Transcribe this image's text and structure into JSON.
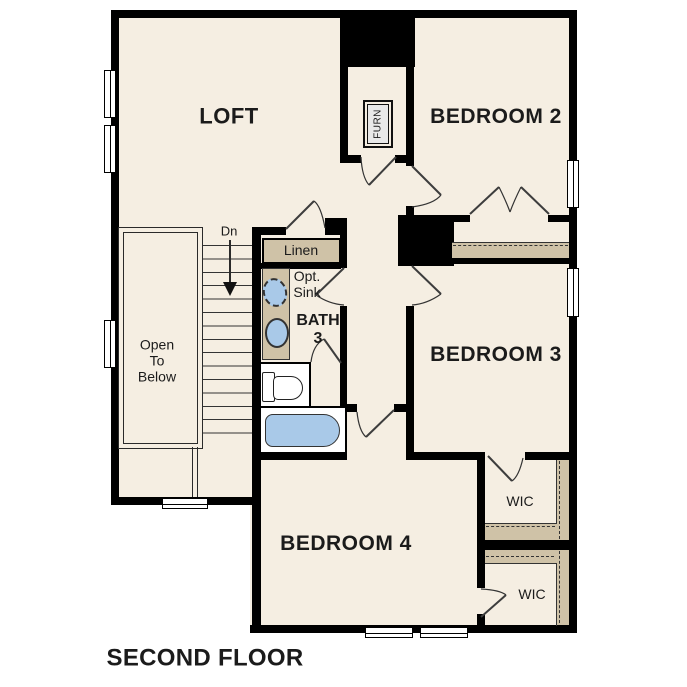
{
  "title": "SECOND FLOOR",
  "colors": {
    "floor": "#f5eee2",
    "wall": "#000000",
    "shelf": "#cfc2a7",
    "fixture": "#a9c9e8",
    "text": "#1b1b1b"
  },
  "rooms": {
    "loft": {
      "label": "LOFT"
    },
    "bedroom2": {
      "label": "BEDROOM 2"
    },
    "bedroom3": {
      "label": "BEDROOM 3"
    },
    "bedroom4": {
      "label": "BEDROOM 4"
    },
    "bath3": {
      "label": "BATH\n3"
    },
    "linen": {
      "label": "Linen"
    },
    "optional_sink": {
      "label": "Opt.\nSink"
    },
    "wic_upper": {
      "label": "WIC"
    },
    "wic_lower": {
      "label": "WIC"
    },
    "open_to_below": {
      "label": "Open\nTo\nBelow"
    },
    "furnace": {
      "label": "FURN"
    },
    "stairs": {
      "down_label": "Dn"
    }
  }
}
